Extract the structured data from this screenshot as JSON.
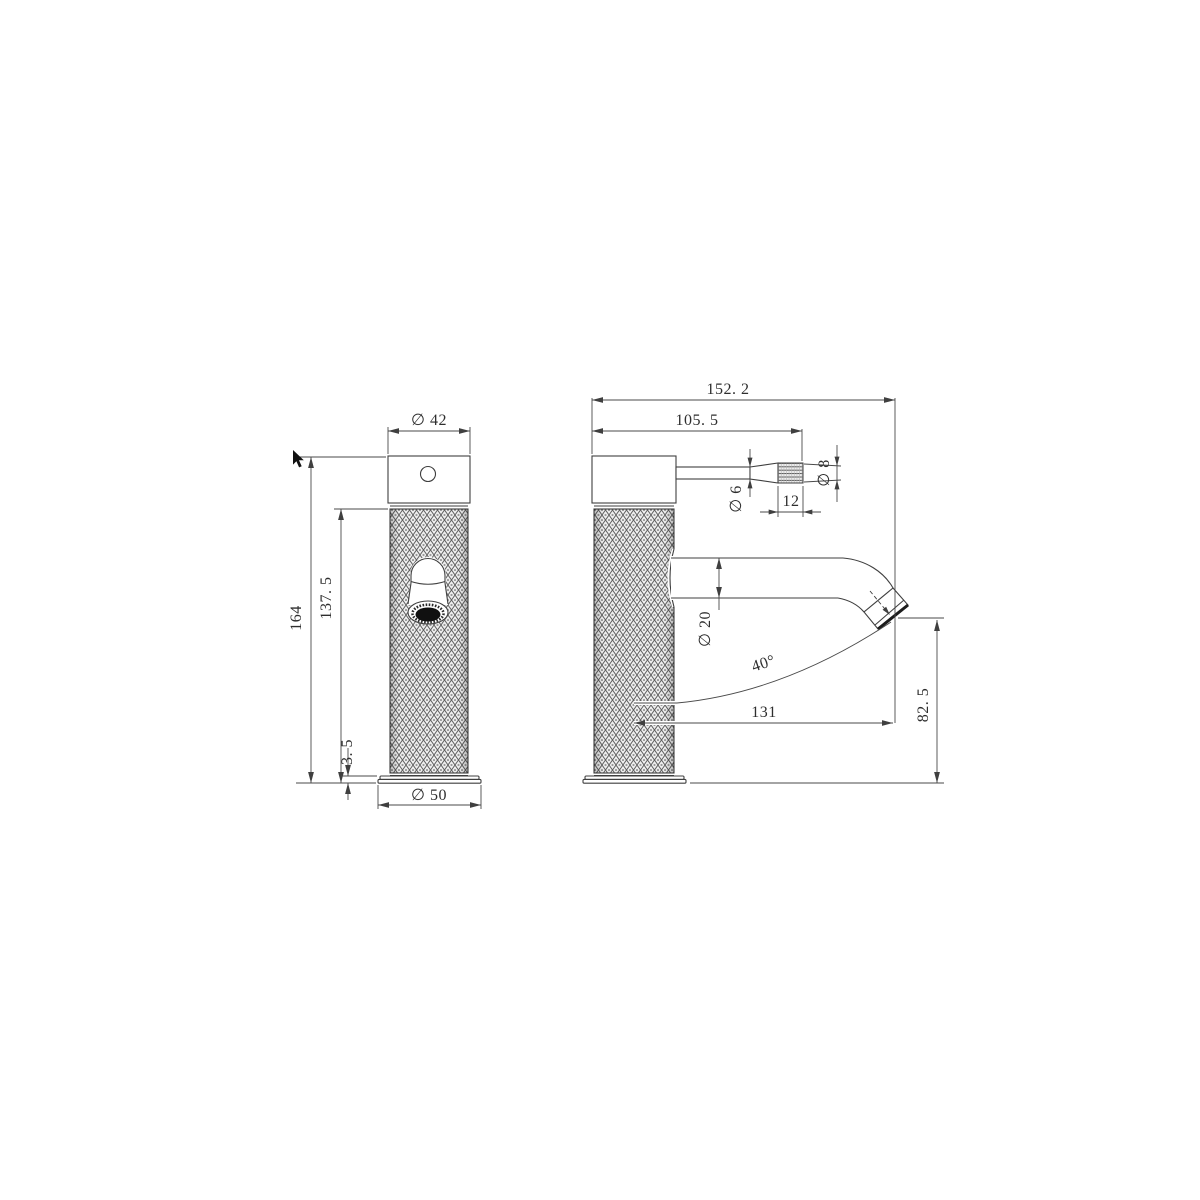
{
  "colors": {
    "background": "#ffffff",
    "line": "#3f3f3f",
    "text": "#2e2e2e",
    "knurl_fill": "#efefef",
    "aerator_dark": "#101010"
  },
  "drawing": {
    "kind": "faucet-orthographic-technical-drawing",
    "front_view": {
      "cap_diameter": "∅ 42",
      "overall_height": "164",
      "body_height": "137. 5",
      "base_plate_height": "3. 5",
      "base_diameter": "∅ 50"
    },
    "side_view": {
      "overall_length": "152. 2",
      "handle_reach": "105. 5",
      "handle_rod_diameter": "∅ 6",
      "handle_grip_length": "12",
      "handle_grip_diameter": "∅ 8",
      "spout_diameter": "∅ 20",
      "spout_angle": "40°",
      "spout_reach": "131",
      "outlet_height": "82. 5"
    }
  }
}
